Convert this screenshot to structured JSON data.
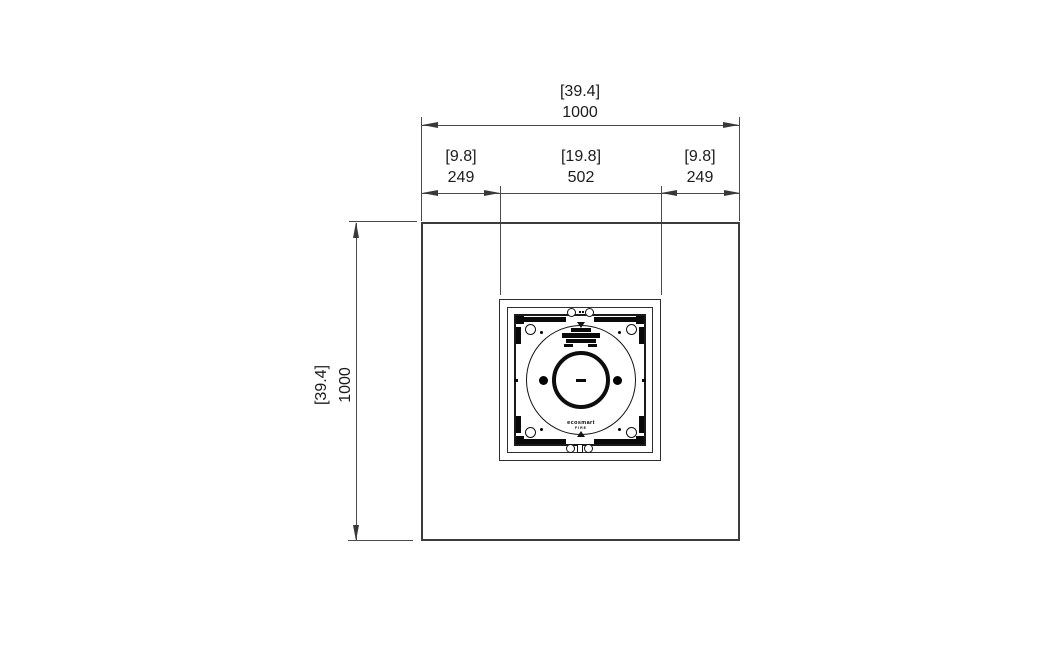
{
  "drawing": {
    "type": "technical-dimension-drawing-top-view",
    "colors": {
      "background": "#ffffff",
      "outline": "#3c3c3c",
      "dimension_lines": "#4a4a4a",
      "text": "#1b1b1b",
      "detail": "#0a0a0a"
    },
    "dimensions": {
      "overall_width": {
        "inches": "[39.4]",
        "mm": "1000"
      },
      "overall_height": {
        "inches": "[39.4]",
        "mm": "1000"
      },
      "offset_left": {
        "inches": "[9.8]",
        "mm": "249"
      },
      "burner_width": {
        "inches": "[19.8]",
        "mm": "502"
      },
      "offset_right": {
        "inches": "[9.8]",
        "mm": "249"
      }
    },
    "burner": {
      "brand_line1": "ecosmart",
      "brand_line2": "FIRE"
    }
  }
}
